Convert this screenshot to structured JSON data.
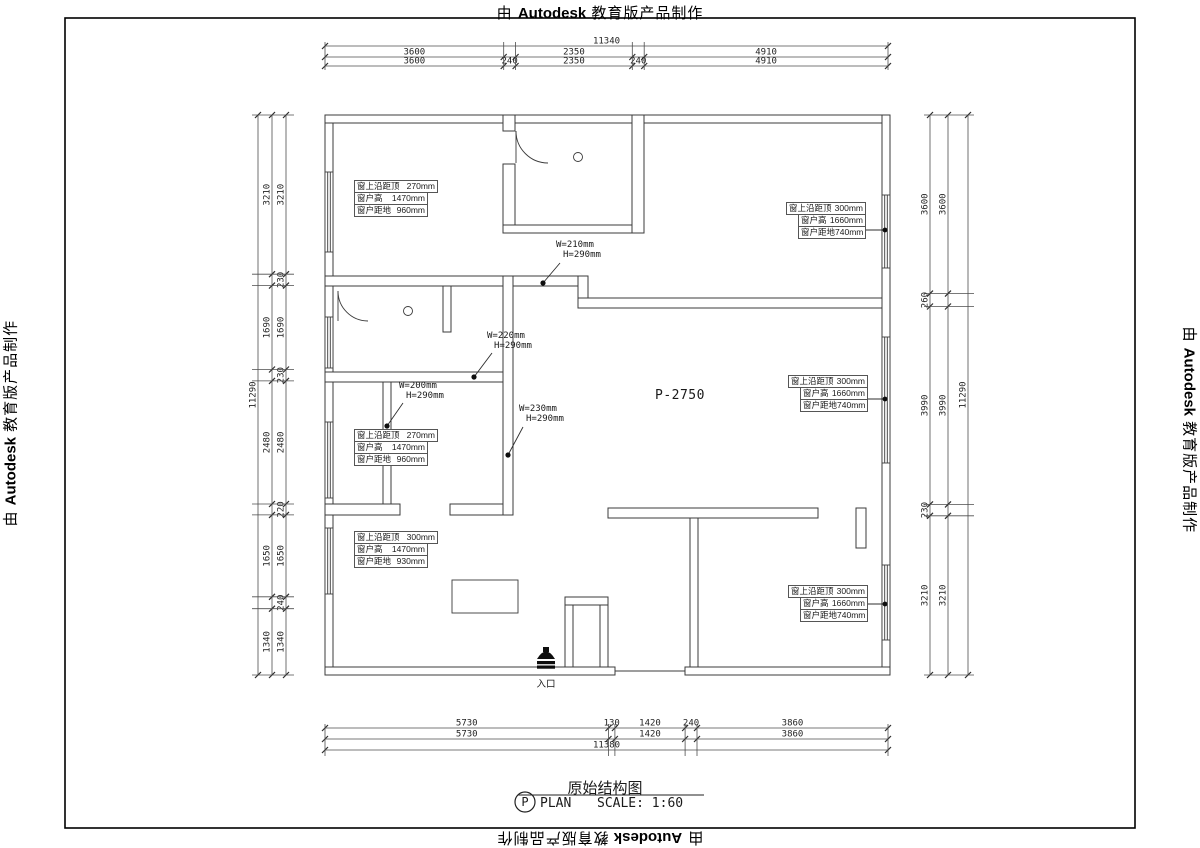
{
  "watermark": {
    "prefix": "由 ",
    "brand": "Autodesk",
    "suffix": " 教育版产品制作"
  },
  "dims": {
    "top": {
      "total": "11340",
      "row1": [
        "3600",
        "2350",
        "4910"
      ],
      "row2": [
        "3600",
        "240",
        "2350",
        "240",
        "4910"
      ]
    },
    "bottom": {
      "total": "11380",
      "row1": [
        "5730",
        "130",
        "1420",
        "240",
        "3860"
      ],
      "row2": [
        "5730",
        "1420",
        "3860"
      ]
    },
    "left": {
      "total": "11290",
      "outer": [
        "3210",
        "1690",
        "2480",
        "1650",
        "1340"
      ],
      "inner": [
        "3210",
        "230",
        "1690",
        "230",
        "2480",
        "220",
        "1650",
        "240",
        "1340"
      ]
    },
    "right": {
      "total": "11290",
      "inner": [
        "3600",
        "260",
        "3990",
        "230",
        "3210"
      ],
      "outer": [
        "3600",
        "3990",
        "3210"
      ]
    }
  },
  "windows": {
    "a1": {
      "rows": [
        {
          "k": "窗上沿距顶",
          "v": "270mm"
        },
        {
          "k": "窗户高",
          "v": "1470mm"
        },
        {
          "k": "窗户距地",
          "v": "960mm"
        }
      ]
    },
    "a2": {
      "rows": [
        {
          "k": "窗上沿距顶",
          "v": "300mm"
        },
        {
          "k": "窗户高",
          "v": "1660mm"
        },
        {
          "k": "窗户距地",
          "v": "740mm"
        }
      ]
    },
    "a3": {
      "rows": [
        {
          "k": "窗上沿距顶",
          "v": "300mm"
        },
        {
          "k": "窗户高",
          "v": "1660mm"
        },
        {
          "k": "窗户距地",
          "v": "740mm"
        }
      ]
    },
    "a4": {
      "rows": [
        {
          "k": "窗上沿距顶",
          "v": "300mm"
        },
        {
          "k": "窗户高",
          "v": "1660mm"
        },
        {
          "k": "窗户距地",
          "v": "740mm"
        }
      ]
    },
    "a5": {
      "rows": [
        {
          "k": "窗上沿距顶",
          "v": "270mm"
        },
        {
          "k": "窗户高",
          "v": "1470mm"
        },
        {
          "k": "窗户距地",
          "v": "960mm"
        }
      ]
    },
    "a6": {
      "rows": [
        {
          "k": "窗上沿距顶",
          "v": "300mm"
        },
        {
          "k": "窗户高",
          "v": "1470mm"
        },
        {
          "k": "窗户距地",
          "v": "930mm"
        }
      ]
    }
  },
  "beams": [
    {
      "w": "W=210mm",
      "h": "H=290mm"
    },
    {
      "w": "W=220mm",
      "h": "H=290mm"
    },
    {
      "w": "W=200mm",
      "h": "H=290mm"
    },
    {
      "w": "W=230mm",
      "h": "H=290mm"
    }
  ],
  "labels": {
    "room": "P-2750",
    "entrance": "入口"
  },
  "title": {
    "drawing": "原始结构图",
    "badge": "P",
    "plan": "PLAN",
    "scale": "SCALE: 1:60"
  }
}
